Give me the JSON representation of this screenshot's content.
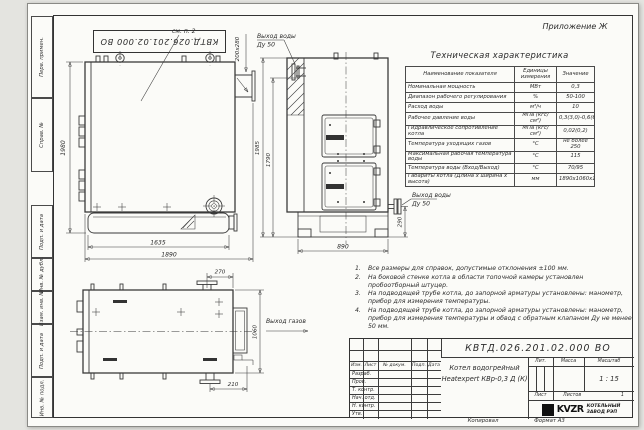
{
  "colors": {
    "paper": "#fbfbf8",
    "background": "#e4e4e0",
    "line": "#3a3a3a"
  },
  "appendix_label": "Приложение Ж",
  "frame": {
    "top_stamp": "КВТД.026.201.02.000 ВО",
    "side_labels": [
      "Перв. примен.",
      "Справ. №",
      "Подп. и дата",
      "Инв. № дубл.",
      "Взам. инв. №",
      "Подп. и дата",
      "Инв. № подл."
    ],
    "copy_label": "Копировал",
    "format_label": "Формат А3"
  },
  "spec_table": {
    "title": "Техническая характеристика",
    "headers": [
      "Наименование показателя",
      "Единицы измерения",
      "Значение"
    ],
    "rows": [
      [
        "Номинальная мощность",
        "МВт",
        "0,3"
      ],
      [
        "Диапазон рабочего регулирования",
        "%",
        "50-100"
      ],
      [
        "Расход воды",
        "м³/ч",
        "10"
      ],
      [
        "Рабочее давление воды",
        "МПа (кгс/см²)",
        "0,3(3,0)-0,6(6,0)"
      ],
      [
        "Гидравлическое сопротивление котла",
        "МПа (кгс/см²)",
        "0,02(0,2)"
      ],
      [
        "Температура уходящих газов",
        "°С",
        "не более 250"
      ],
      [
        "Максимальная рабочая температура воды",
        "°С",
        "115"
      ],
      [
        "Температура воды (Вход/Выход)",
        "°С",
        "70/95"
      ],
      [
        "Габариты котла (Длина х ширина х высота)",
        "мм",
        "1890х1060х1980"
      ]
    ]
  },
  "notes": [
    {
      "num": "1.",
      "text": "Все размеры для справок, допустимые отклонения ±100 мм."
    },
    {
      "num": "2.",
      "text": "На боковой стенке котла в области топочной камеры установлен пробоотборный штуцер."
    },
    {
      "num": "3.",
      "text": "На подводящей трубе котла, до запорной арматуры установлены: манометр, прибор для измерения температуры."
    },
    {
      "num": "4.",
      "text": "На подводящей трубе котла, до запорной арматуры установлены: манометр, прибор для измерения температуры и обвод с обратным клапаном Ду не менее 50 мм."
    }
  ],
  "views": {
    "front": {
      "dim_height": "1980",
      "dim_base": "1635",
      "dim_length": "1890",
      "dim_flue": "200х280",
      "note_ref": "см. п. 2"
    },
    "side": {
      "dim_height_overall": "1985",
      "dim_height_inner": "1790",
      "dim_width": "890",
      "dim_nozzle_height": "290",
      "outlet_top_line1": "Выход воды",
      "outlet_top_line2": "Ду 50",
      "outlet_side_line1": "Выход воды",
      "outlet_side_line2": "Ду 50"
    },
    "top": {
      "dim_flange": "270",
      "dim_outlet": "210",
      "dim_width": "1060",
      "gas_label": "Выход газов"
    }
  },
  "title_block": {
    "doc_number": "КВТД.026.201.02.000 ВО",
    "name_line1": "Котел водогрейный",
    "name_line2": "Heatexpert КВр-0,3 Д (К)",
    "col_headers": [
      "Изм.",
      "Лист",
      "№ докум.",
      "Подп.",
      "Дата"
    ],
    "roles": [
      "Разраб.",
      "Пров.",
      "Т. контр.",
      "Нач. отд.",
      "Н. контр.",
      "Утв."
    ],
    "lit_label": "Лит.",
    "mass_label": "Масса",
    "scale_label": "Масштаб",
    "scale_value": "1 : 15",
    "sheet_label": "Лист",
    "sheets_label": "Листов",
    "sheets_value": "1",
    "logo_text": "KVZR",
    "company_line1": "КОТЕЛЬНЫЙ",
    "company_line2": "ЗАВОД РЭП"
  }
}
